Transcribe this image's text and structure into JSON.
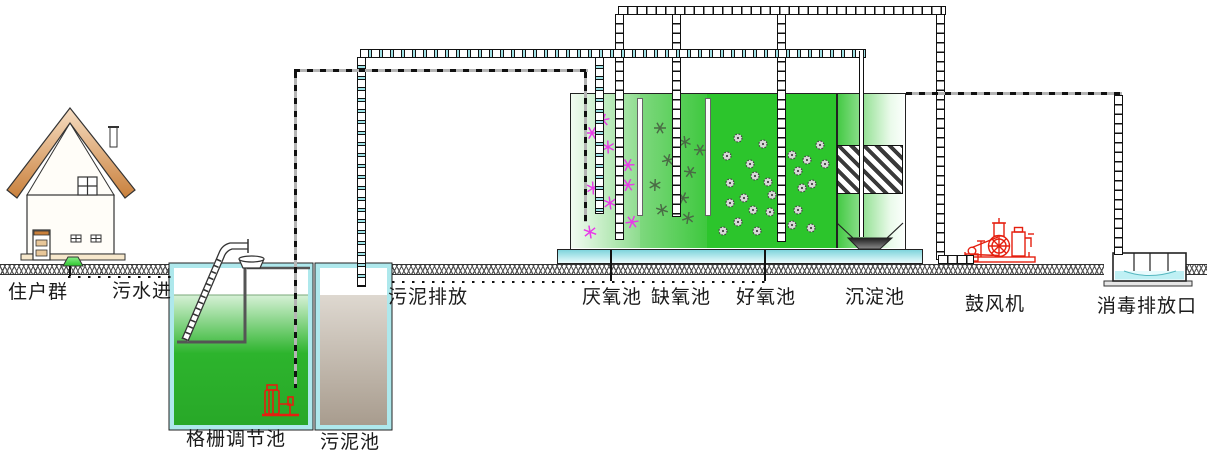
{
  "diagram_title": "生活污水A2O处理工艺流程示意图",
  "labels": {
    "residents": "住户群",
    "sewage_in": "污水进",
    "grid_regulating_tank": "格栅调节池",
    "sludge_tank": "污泥池",
    "sludge_discharge": "污泥排放",
    "anaerobic_tank": "厌氧池",
    "anoxic_tank": "缺氧池",
    "aerobic_tank": "好氧池",
    "sedimentation_tank": "沉淀池",
    "blower": "鼓风机",
    "disinfection_outlet": "消毒排放口"
  },
  "colors": {
    "machine_red": "#e51f0f",
    "pipe_cyan": "#9fe2e6",
    "wall_cyan": "#aee8ec",
    "anaerobic_bacteria_magenta": "#e83ae8",
    "anoxic_bacteria_olive": "#4a6b45",
    "floc_gray": "#444444",
    "aerobic_green": "#2cc52c",
    "roof_brown": "#c9803c",
    "sludge_brown": "#a89c8e",
    "water_green": "#2db42d"
  }
}
